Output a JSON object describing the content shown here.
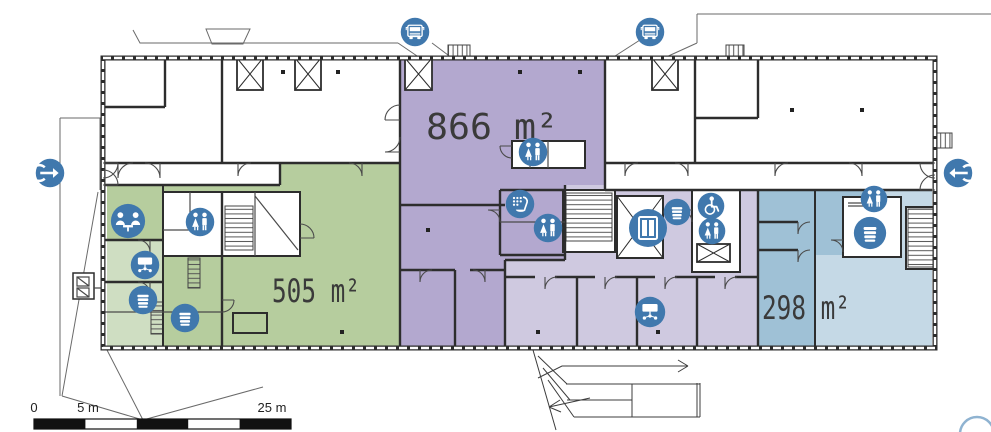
{
  "plan": {
    "area_labels": [
      {
        "name": "area-866",
        "text": "866 m²"
      },
      {
        "name": "area-505",
        "text": "505 m²"
      },
      {
        "name": "area-298",
        "text": "298 m²"
      }
    ],
    "scale_bar": {
      "tick0": "0",
      "tick1": "5 m",
      "tick2": "25 m"
    },
    "icons": {
      "truck-icon": "truck front (loading dock)",
      "entrance-right-icon": "arrow entering building from left",
      "entrance-left-icon": "arrow entering building from right",
      "restroom-icon": "woman and man figures",
      "meeting-room-icon": "two people at a table",
      "presentation-icon": "screen with connected devices",
      "coffee-icon": "striped cup / coffee point",
      "cleaning-icon": "dots grid with scoop",
      "elevator-icon": "elevator doors",
      "accessible-icon": "wheelchair user"
    }
  },
  "colors": {
    "wall": "#2d2d2d",
    "wall_light": "#4a4a4a",
    "icon_blue": "#4078ad",
    "icon_glyph": "#ffffff",
    "green_light": "#cfdec2",
    "green": "#b6cd9e",
    "purple": "#b3a8cf",
    "lavender": "#cfc9e0",
    "blue": "#9fc1d6",
    "blue_light": "#c5d9e6",
    "label_text": "#3a3a3a",
    "scale_ink": "#111111",
    "compass_arc": "#8fb3d1"
  }
}
